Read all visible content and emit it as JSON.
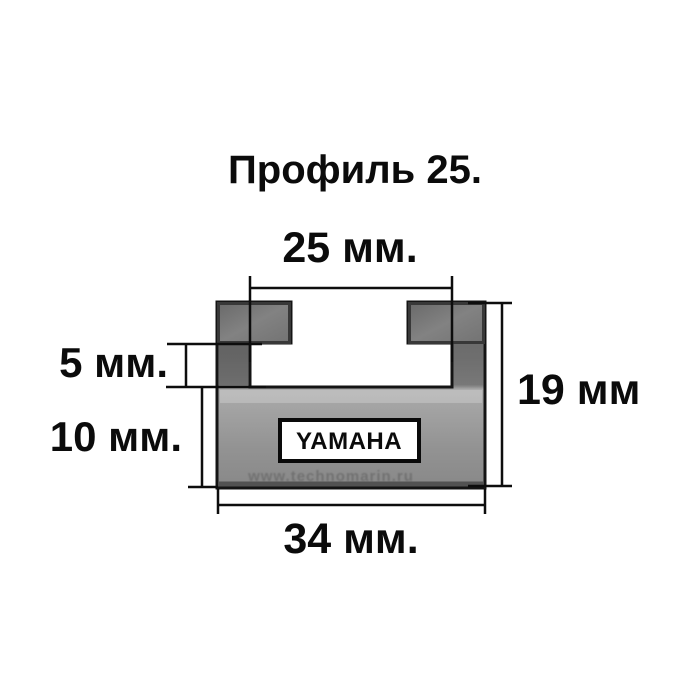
{
  "title": "Профиль 25.",
  "diagram": {
    "type": "profile-cross-section",
    "dimensions": {
      "top_width": "25 мм.",
      "lip_depth": "5 мм.",
      "base_height": "10 мм.",
      "total_height": "19 мм",
      "bottom_width": "34 мм."
    },
    "brand_label": "YAMAHA",
    "watermark": "www.technomarin.ru"
  },
  "colors": {
    "background": "#ffffff",
    "body_gray": "#8f8f8f",
    "tab_gray": "#777777",
    "outline": "#141414",
    "dimension_lines": "#0d0d0d",
    "text": "#0b0b0b"
  }
}
